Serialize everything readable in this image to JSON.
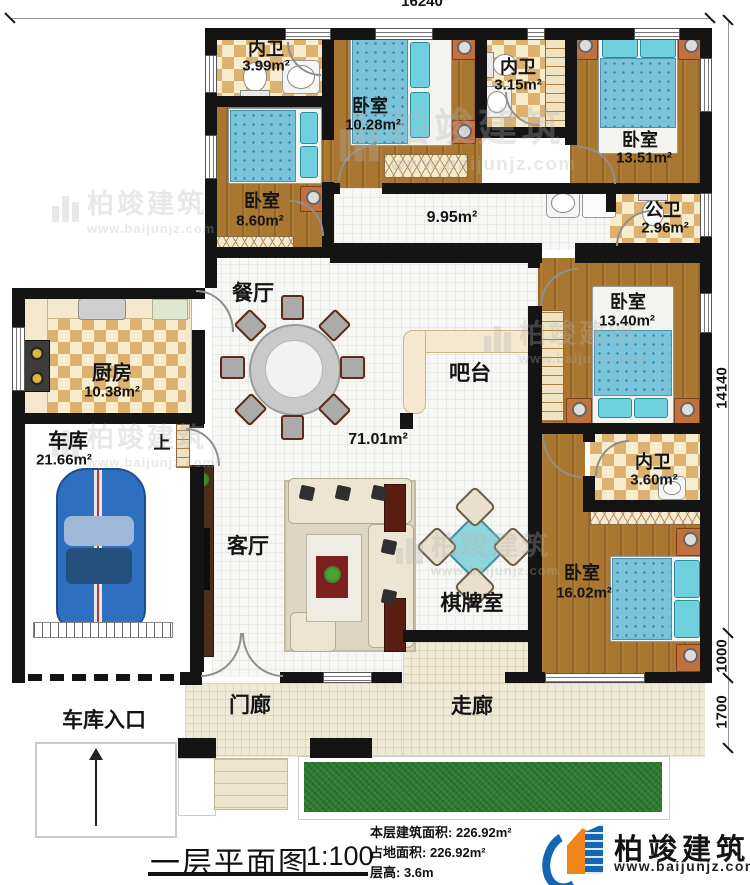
{
  "dims": {
    "width_top": "16240",
    "height_right": "14140",
    "seg_1000": "1000",
    "seg_1700": "1700"
  },
  "rooms": {
    "neiwei_a": {
      "name": "内卫",
      "area": "3.99m²"
    },
    "bedroom_a": {
      "name": "卧室",
      "area": "10.28m²"
    },
    "neiwei_b": {
      "name": "内卫",
      "area": "3.15m²"
    },
    "bedroom_b": {
      "name": "卧室",
      "area": "13.51m²"
    },
    "bedroom_c": {
      "name": "卧室",
      "area": "8.60m²"
    },
    "gongwei": {
      "name": "公卫",
      "area": "2.96m²"
    },
    "hallway": {
      "area": "9.95m²"
    },
    "dining": {
      "name": "餐厅"
    },
    "kitchen": {
      "name": "厨房",
      "area": "10.38m²"
    },
    "bar": {
      "name": "吧台"
    },
    "bedroom_d": {
      "name": "卧室",
      "area": "13.40m²"
    },
    "garage": {
      "name": "车库",
      "area": "21.66m²"
    },
    "stairs": {
      "label": "上"
    },
    "living": {
      "name": "客厅",
      "area": "71.01m²"
    },
    "neiwei_c": {
      "name": "内卫",
      "area": "3.60m²"
    },
    "chess": {
      "name": "棋牌室"
    },
    "bedroom_e": {
      "name": "卧室",
      "area": "16.02m²"
    },
    "porch": {
      "name": "门廊"
    },
    "corridor": {
      "name": "走廊"
    },
    "garage_entrance": {
      "name": "车库入口"
    }
  },
  "footer": {
    "title": "一层平面图",
    "scale": "1:100",
    "stats": [
      {
        "label": "本层建筑面积:",
        "value": "226.92m²"
      },
      {
        "label": "占地面积:",
        "value": "226.92m²"
      },
      {
        "label": "层高:",
        "value": "3.6m"
      }
    ],
    "brand": "柏竣建筑",
    "website": "www.baijunjz.com"
  },
  "watermark": {
    "brand": "柏竣建筑",
    "website": "www.baijunjz.com"
  },
  "colors": {
    "wall": "#141414",
    "wood_floor": "#a9772f",
    "tile_check": "#ddb26e",
    "bed_blue": "#79c4da",
    "brand_blue": "#1266b4",
    "brand_orange": "#ef8418",
    "grass_green": "#2f7d31"
  }
}
